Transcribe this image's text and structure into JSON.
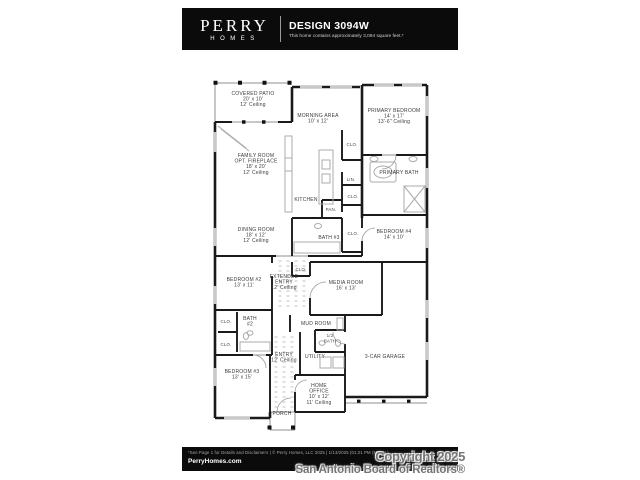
{
  "header": {
    "brand_name": "PERRY",
    "brand_sub": "HOMES",
    "design_title": "DESIGN 3094W",
    "design_subtitle": "This home contains approximately 3,094 square feet.*"
  },
  "plan": {
    "labels": [
      {
        "name": "covered-patio",
        "x": 253,
        "y": 95,
        "lines": [
          "COVERED PATIO",
          "20' x 10'",
          "12' Ceiling"
        ]
      },
      {
        "name": "morning-area",
        "x": 318,
        "y": 117,
        "lines": [
          "MORNING AREA",
          "10' x 12'"
        ]
      },
      {
        "name": "primary-bedroom",
        "x": 394,
        "y": 112,
        "lines": [
          "PRIMARY BEDROOM",
          "14' x 17'",
          "13'-6\" Ceiling"
        ]
      },
      {
        "name": "family-room",
        "x": 256,
        "y": 157,
        "lines": [
          "FAMILY ROOM",
          "OPT. FIREPLACE",
          "18' x 20'",
          "12' Ceiling"
        ]
      },
      {
        "name": "clo-primary",
        "x": 352,
        "y": 146,
        "lines": [
          "CLO."
        ],
        "small": true
      },
      {
        "name": "primary-bath",
        "x": 399,
        "y": 174,
        "lines": [
          "PRIMARY BATH"
        ]
      },
      {
        "name": "lin",
        "x": 351,
        "y": 181,
        "lines": [
          "LIN."
        ],
        "small": true
      },
      {
        "name": "kitchen",
        "x": 306,
        "y": 201,
        "lines": [
          "KITCHEN"
        ]
      },
      {
        "name": "clo-hall",
        "x": 353,
        "y": 198,
        "lines": [
          "CLO."
        ],
        "small": true
      },
      {
        "name": "pan",
        "x": 331,
        "y": 211,
        "lines": [
          "PAN."
        ],
        "small": true
      },
      {
        "name": "dining-room",
        "x": 256,
        "y": 231,
        "lines": [
          "DINING ROOM",
          "18' x 12'",
          "12' Ceiling"
        ]
      },
      {
        "name": "bath-3",
        "x": 329,
        "y": 239,
        "lines": [
          "BATH #3"
        ]
      },
      {
        "name": "clo-bedroom4",
        "x": 353,
        "y": 235,
        "lines": [
          "CLO."
        ],
        "small": true
      },
      {
        "name": "bedroom-4",
        "x": 394,
        "y": 233,
        "lines": [
          "BEDROOM #4",
          "14' x 10'"
        ]
      },
      {
        "name": "clo-extended-entry",
        "x": 301,
        "y": 271,
        "lines": [
          "CLO."
        ],
        "small": true
      },
      {
        "name": "bedroom-2",
        "x": 244,
        "y": 281,
        "lines": [
          "BEDROOM #2",
          "13' x 11'"
        ]
      },
      {
        "name": "extended-entry",
        "x": 284,
        "y": 278,
        "lines": [
          "EXTENDED",
          "ENTRY",
          "12' Ceiling"
        ]
      },
      {
        "name": "media-room",
        "x": 346,
        "y": 284,
        "lines": [
          "MEDIA ROOM",
          "16' x 13'"
        ]
      },
      {
        "name": "clo-bath2-upper",
        "x": 226,
        "y": 323,
        "lines": [
          "CLO."
        ],
        "small": true
      },
      {
        "name": "bath-2",
        "x": 250,
        "y": 320,
        "lines": [
          "BATH",
          "#2"
        ]
      },
      {
        "name": "clo-bath2-lower",
        "x": 226,
        "y": 346,
        "lines": [
          "CLO."
        ],
        "small": true
      },
      {
        "name": "mud-room",
        "x": 316,
        "y": 325,
        "lines": [
          "MUD ROOM"
        ]
      },
      {
        "name": "half-bath",
        "x": 330,
        "y": 337,
        "lines": [
          "1/2",
          "BATH"
        ],
        "small": true
      },
      {
        "name": "entry",
        "x": 284,
        "y": 356,
        "lines": [
          "ENTRY",
          "12' Ceiling"
        ]
      },
      {
        "name": "utility",
        "x": 315,
        "y": 358,
        "lines": [
          "UTILITY"
        ]
      },
      {
        "name": "garage",
        "x": 385,
        "y": 358,
        "lines": [
          "3-CAR GARAGE"
        ]
      },
      {
        "name": "bedroom-3",
        "x": 242,
        "y": 373,
        "lines": [
          "BEDROOM #3",
          "13' x 15'"
        ]
      },
      {
        "name": "home-office",
        "x": 319,
        "y": 387,
        "lines": [
          "HOME",
          "OFFICE",
          "10' x 12'",
          "11' Ceiling"
        ]
      },
      {
        "name": "porch",
        "x": 282,
        "y": 415,
        "lines": [
          "PORCH"
        ]
      }
    ]
  },
  "footer": {
    "disclaimer": "*See Page 1 for Details and Disclaimers  |  © Perry Homes, LLC 2025  |  1/13/2025 (01:21 PM  (MF-CL)",
    "website": "PerryHomes.com"
  },
  "watermark": {
    "line1": "Copyright 2025",
    "line2": "San Antonio Board of Realtors®"
  },
  "colors": {
    "wall": "#1a1a1a",
    "bar_background": "#0b0b0b",
    "watermark_gray": "#747474"
  }
}
